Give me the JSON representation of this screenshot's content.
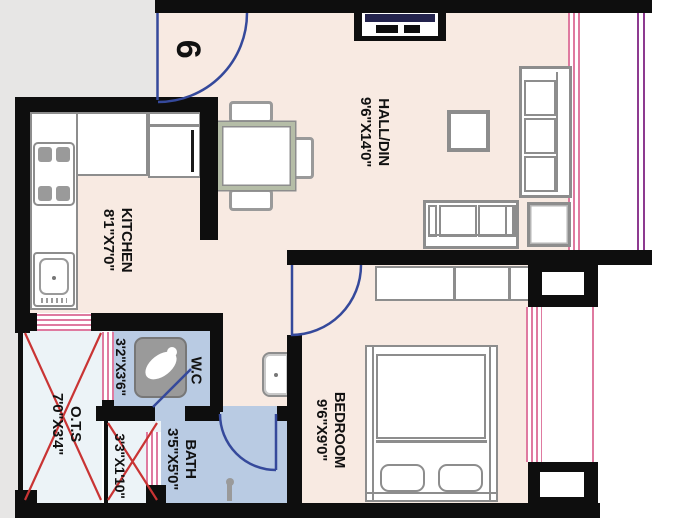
{
  "unit_number": "6",
  "rooms": {
    "hall": {
      "name": "HALL/DIN",
      "dims": "9'6\"X14'0\""
    },
    "kitchen": {
      "name": "KITCHEN",
      "dims": "8'1\"X7'0\""
    },
    "bedroom": {
      "name": "BEDROOM",
      "dims": "9'6\"X9'0\""
    },
    "wc": {
      "name": "W.C",
      "dims": "3'2\"X3'6\""
    },
    "bath": {
      "name": "BATH",
      "dims": "3'5\"X5'0\""
    },
    "ots": {
      "name": "O.T.S",
      "dims": "7'0\"X3'4\""
    },
    "duct": {
      "dims": "3'3\"X1'10\""
    }
  },
  "colors": {
    "wall": "#0e0e0e",
    "floor": "#f8eae2",
    "wet_floor": "#b9cbe3",
    "shaft_floor": "#ecf3f7",
    "outside_left": "#e7e6e5",
    "window_pink": "#df7aa0",
    "boundary_purple": "#8d3a90",
    "door_blue": "#35499b",
    "cross_red": "#c93434",
    "furniture_gray": "#8d8d8d",
    "tv_screen_navy": "#23234d"
  }
}
